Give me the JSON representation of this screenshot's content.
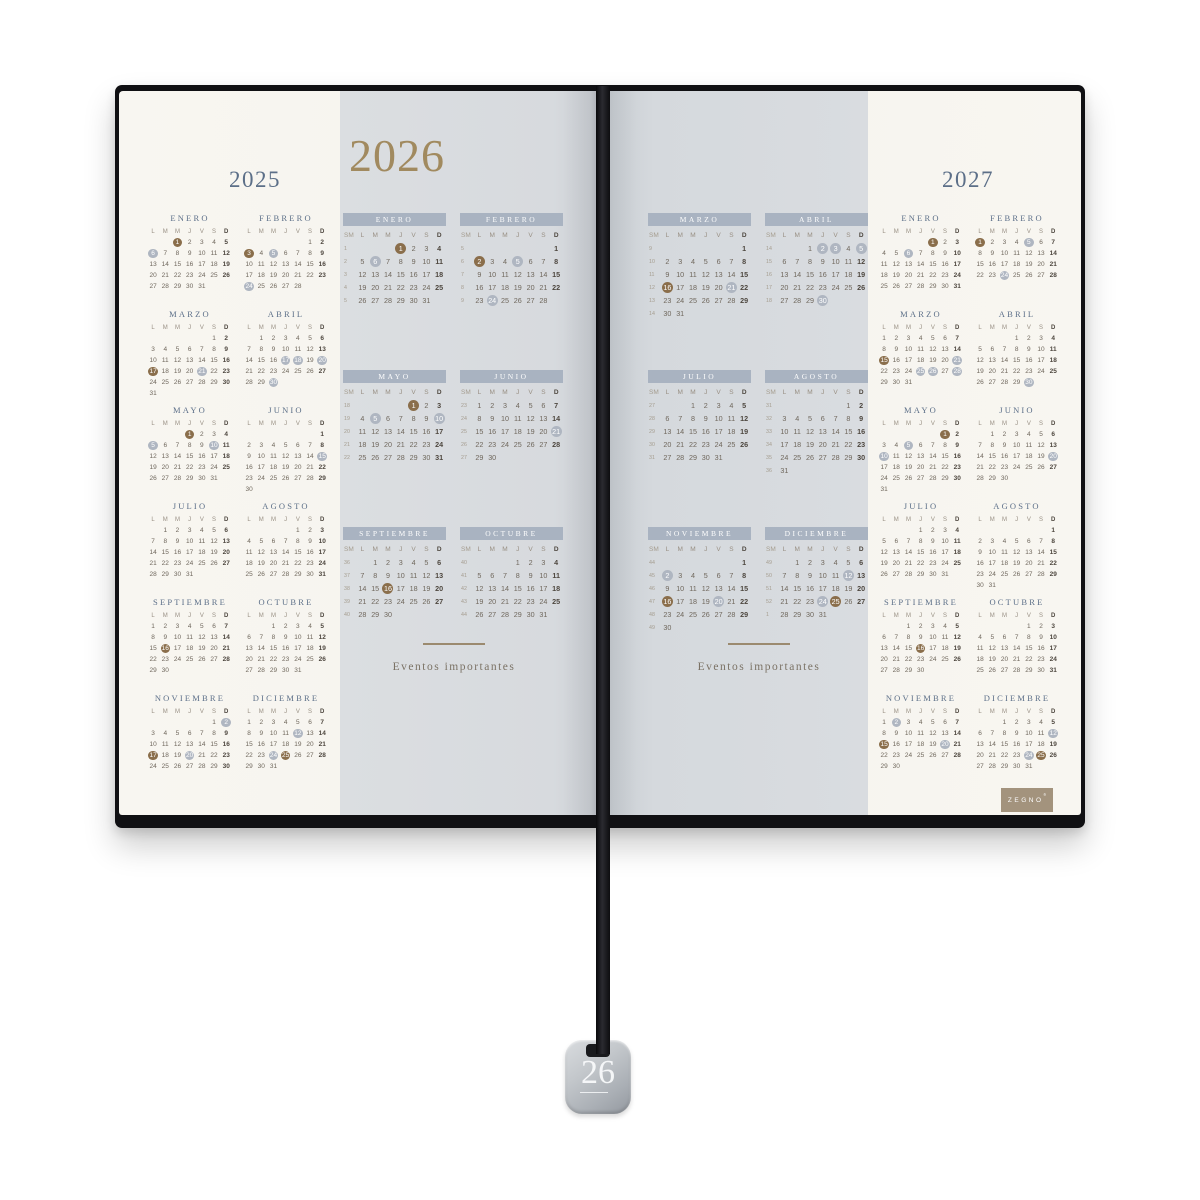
{
  "colors": {
    "year_slate": "#5c6f88",
    "year_gold": "#a18a5f",
    "title_slate": "#5c6f88",
    "month_bar": "#a9b3c1",
    "day_text": "#6f675c",
    "sunday_text": "#4d463e",
    "week_num": "#a59d8f",
    "holiday_brown": "#8a6e4b",
    "holiday_gray": "#afb6c1",
    "logo_tan": "#a3937d"
  },
  "weekdays": [
    "L",
    "M",
    "M",
    "J",
    "V",
    "S",
    "D"
  ],
  "week_col": "SM",
  "left_page": {
    "year": "2025",
    "months": [
      {
        "label": "ENERO",
        "start": 2,
        "days": 31,
        "brown": [
          1
        ],
        "gray": [
          6
        ]
      },
      {
        "label": "FEBRERO",
        "start": 5,
        "days": 28,
        "brown": [
          3
        ],
        "gray": [
          5,
          24
        ]
      },
      {
        "label": "MARZO",
        "start": 5,
        "days": 31,
        "brown": [
          17
        ],
        "gray": [
          21
        ]
      },
      {
        "label": "ABRIL",
        "start": 1,
        "days": 30,
        "brown": [],
        "gray": [
          17,
          18,
          20,
          30
        ]
      },
      {
        "label": "MAYO",
        "start": 3,
        "days": 31,
        "brown": [
          1
        ],
        "gray": [
          5,
          10
        ]
      },
      {
        "label": "JUNIO",
        "start": 6,
        "days": 30,
        "brown": [],
        "gray": [
          15
        ]
      },
      {
        "label": "JULIO",
        "start": 1,
        "days": 31,
        "brown": [],
        "gray": []
      },
      {
        "label": "AGOSTO",
        "start": 4,
        "days": 31,
        "brown": [],
        "gray": []
      },
      {
        "label": "SEPTIEMBRE",
        "start": 0,
        "days": 30,
        "brown": [
          16
        ],
        "gray": []
      },
      {
        "label": "OCTUBRE",
        "start": 2,
        "days": 31,
        "brown": [],
        "gray": []
      },
      {
        "label": "NOVIEMBRE",
        "start": 5,
        "days": 30,
        "brown": [
          17
        ],
        "gray": [
          2,
          20
        ]
      },
      {
        "label": "DICIEMBRE",
        "start": 0,
        "days": 31,
        "brown": [
          25
        ],
        "gray": [
          12,
          24
        ]
      }
    ]
  },
  "spread": {
    "year": "2026",
    "events_label": "Eventos importantes",
    "left_months": [
      {
        "label": "ENERO",
        "start": 3,
        "days": 31,
        "brown": [
          1
        ],
        "gray": [
          6
        ],
        "weeks": [
          1,
          2,
          3,
          4,
          5
        ]
      },
      {
        "label": "FEBRERO",
        "start": 6,
        "days": 28,
        "brown": [
          2
        ],
        "gray": [
          5,
          24
        ],
        "weeks": [
          5,
          6,
          7,
          8,
          9
        ]
      },
      {
        "label": "MAYO",
        "start": 4,
        "days": 31,
        "brown": [
          1
        ],
        "gray": [
          5,
          10
        ],
        "weeks": [
          18,
          19,
          20,
          21,
          22
        ]
      },
      {
        "label": "JUNIO",
        "start": 0,
        "days": 30,
        "brown": [],
        "gray": [
          21
        ],
        "weeks": [
          23,
          24,
          25,
          26,
          27
        ]
      },
      {
        "label": "SEPTIEMBRE",
        "start": 1,
        "days": 30,
        "brown": [
          16
        ],
        "gray": [],
        "weeks": [
          36,
          37,
          38,
          39,
          40
        ]
      },
      {
        "label": "OCTUBRE",
        "start": 3,
        "days": 31,
        "brown": [],
        "gray": [],
        "weeks": [
          40,
          41,
          42,
          43,
          44
        ]
      }
    ],
    "right_months": [
      {
        "label": "MARZO",
        "start": 6,
        "days": 31,
        "brown": [
          16
        ],
        "gray": [
          21
        ],
        "weeks": [
          9,
          10,
          11,
          12,
          13,
          14
        ]
      },
      {
        "label": "ABRIL",
        "start": 2,
        "days": 30,
        "brown": [],
        "gray": [
          2,
          3,
          5,
          30
        ],
        "weeks": [
          14,
          15,
          16,
          17,
          18
        ]
      },
      {
        "label": "JULIO",
        "start": 2,
        "days": 31,
        "brown": [],
        "gray": [],
        "weeks": [
          27,
          28,
          29,
          30,
          31
        ]
      },
      {
        "label": "AGOSTO",
        "start": 5,
        "days": 31,
        "brown": [],
        "gray": [],
        "weeks": [
          31,
          32,
          33,
          34,
          35,
          36
        ]
      },
      {
        "label": "NOVIEMBRE",
        "start": 6,
        "days": 30,
        "brown": [
          16
        ],
        "gray": [
          2,
          20
        ],
        "weeks": [
          44,
          45,
          46,
          47,
          48,
          49
        ]
      },
      {
        "label": "DICIEMBRE",
        "start": 1,
        "days": 31,
        "brown": [
          25
        ],
        "gray": [
          12,
          24
        ],
        "weeks": [
          49,
          50,
          51,
          52,
          1
        ]
      }
    ]
  },
  "right_page": {
    "year": "2027",
    "months": [
      {
        "label": "ENERO",
        "start": 4,
        "days": 31,
        "brown": [
          1
        ],
        "gray": [
          6
        ]
      },
      {
        "label": "FEBRERO",
        "start": 0,
        "days": 28,
        "brown": [
          1
        ],
        "gray": [
          5,
          24
        ]
      },
      {
        "label": "MARZO",
        "start": 0,
        "days": 31,
        "brown": [
          15
        ],
        "gray": [
          21,
          25,
          26,
          28
        ]
      },
      {
        "label": "ABRIL",
        "start": 3,
        "days": 30,
        "brown": [],
        "gray": [
          30
        ]
      },
      {
        "label": "MAYO",
        "start": 5,
        "days": 31,
        "brown": [
          1
        ],
        "gray": [
          5,
          10
        ]
      },
      {
        "label": "JUNIO",
        "start": 1,
        "days": 30,
        "brown": [],
        "gray": [
          20
        ]
      },
      {
        "label": "JULIO",
        "start": 3,
        "days": 31,
        "brown": [],
        "gray": []
      },
      {
        "label": "AGOSTO",
        "start": 6,
        "days": 31,
        "brown": [],
        "gray": []
      },
      {
        "label": "SEPTIEMBRE",
        "start": 2,
        "days": 30,
        "brown": [
          16
        ],
        "gray": []
      },
      {
        "label": "OCTUBRE",
        "start": 4,
        "days": 31,
        "brown": [],
        "gray": []
      },
      {
        "label": "NOVIEMBRE",
        "start": 0,
        "days": 30,
        "brown": [
          15
        ],
        "gray": [
          2,
          20
        ]
      },
      {
        "label": "DICIEMBRE",
        "start": 2,
        "days": 31,
        "brown": [
          25
        ],
        "gray": [
          12,
          24
        ]
      }
    ]
  },
  "brand": {
    "logo": "ZEGNO",
    "reg": "®"
  },
  "charm": {
    "number": "26"
  }
}
